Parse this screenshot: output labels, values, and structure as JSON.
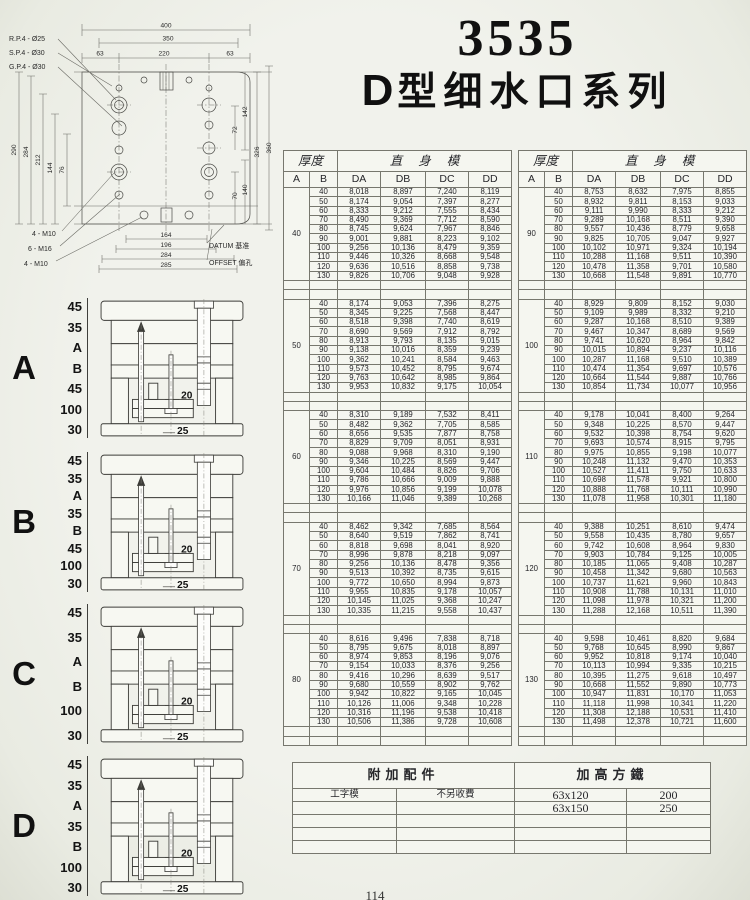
{
  "page": {
    "page_number": "114"
  },
  "colors": {
    "paper": "#f1f2ec",
    "ink": "#222222",
    "table_line": "#77776e"
  },
  "title": {
    "model": "3535",
    "series_prefix": "D",
    "series_text": "型细水口系列"
  },
  "drawing": {
    "callouts_top": [
      "R.P.4 - Ø25",
      "S.P.4 - Ø30",
      "G.P.4 - Ø30"
    ],
    "dims_top": [
      "400",
      "350",
      "63",
      "220",
      "63"
    ],
    "dims_left": [
      "290",
      "284",
      "212",
      "144",
      "76"
    ],
    "dims_right": [
      "142",
      "72",
      "326",
      "360",
      "70",
      "140"
    ],
    "dims_bottom": [
      "164",
      "196",
      "284",
      "285"
    ],
    "callouts_bottom": [
      "4 - M10",
      "6 - M16",
      "4 - M10"
    ],
    "datum_label": "DATUM 基准",
    "offset_label": "OFFSET 偏孔"
  },
  "diagrams": [
    {
      "label": "A",
      "stack": [
        "45",
        "35",
        "A",
        "B",
        "45",
        "100",
        "30"
      ],
      "inner": [
        "20",
        "25"
      ]
    },
    {
      "label": "B",
      "stack": [
        "45",
        "35",
        "A",
        "35",
        "B",
        "45",
        "100",
        "30"
      ],
      "inner": [
        "20",
        "25"
      ]
    },
    {
      "label": "C",
      "stack": [
        "45",
        "35",
        "A",
        "B",
        "100",
        "30"
      ],
      "inner": [
        "20",
        "25"
      ]
    },
    {
      "label": "D",
      "stack": [
        "45",
        "35",
        "A",
        "35",
        "B",
        "100",
        "30"
      ],
      "inner": [
        "20",
        "25"
      ]
    }
  ],
  "price_table": {
    "header_thickness": "厚度",
    "header_straight": "直身模",
    "col_a": "A",
    "col_b": "B",
    "value_cols": [
      "DA",
      "DB",
      "DC",
      "DD"
    ],
    "left_blocks": [
      {
        "a": "40",
        "rows": [
          [
            "40",
            "8,018",
            "8,897",
            "7,240",
            "8,119"
          ],
          [
            "50",
            "8,174",
            "9,054",
            "7,397",
            "8,277"
          ],
          [
            "60",
            "8,333",
            "9,212",
            "7,555",
            "8,434"
          ],
          [
            "70",
            "8,490",
            "9,369",
            "7,712",
            "8,590"
          ],
          [
            "80",
            "8,745",
            "9,624",
            "7,967",
            "8,846"
          ],
          [
            "90",
            "9,001",
            "9,881",
            "8,223",
            "9,102"
          ],
          [
            "100",
            "9,256",
            "10,136",
            "8,479",
            "9,359"
          ],
          [
            "110",
            "9,446",
            "10,326",
            "8,668",
            "9,548"
          ],
          [
            "120",
            "9,636",
            "10,516",
            "8,858",
            "9,738"
          ],
          [
            "130",
            "9,826",
            "10,706",
            "9,048",
            "9,928"
          ]
        ]
      },
      {
        "a": "50",
        "rows": [
          [
            "40",
            "8,174",
            "9,053",
            "7,396",
            "8,275"
          ],
          [
            "50",
            "8,345",
            "9,225",
            "7,568",
            "8,447"
          ],
          [
            "60",
            "8,518",
            "9,398",
            "7,740",
            "8,619"
          ],
          [
            "70",
            "8,690",
            "9,569",
            "7,912",
            "8,792"
          ],
          [
            "80",
            "8,913",
            "9,793",
            "8,135",
            "9,015"
          ],
          [
            "90",
            "9,138",
            "10,016",
            "8,359",
            "9,239"
          ],
          [
            "100",
            "9,362",
            "10,241",
            "8,584",
            "9,463"
          ],
          [
            "110",
            "9,573",
            "10,452",
            "8,795",
            "9,674"
          ],
          [
            "120",
            "9,763",
            "10,642",
            "8,985",
            "9,864"
          ],
          [
            "130",
            "9,953",
            "10,832",
            "9,175",
            "10,054"
          ]
        ]
      },
      {
        "a": "60",
        "rows": [
          [
            "40",
            "8,310",
            "9,189",
            "7,532",
            "8,411"
          ],
          [
            "50",
            "8,482",
            "9,362",
            "7,705",
            "8,585"
          ],
          [
            "60",
            "8,656",
            "9,535",
            "7,877",
            "8,758"
          ],
          [
            "70",
            "8,829",
            "9,709",
            "8,051",
            "8,931"
          ],
          [
            "80",
            "9,088",
            "9,968",
            "8,310",
            "9,190"
          ],
          [
            "90",
            "9,346",
            "10,225",
            "8,569",
            "9,447"
          ],
          [
            "100",
            "9,604",
            "10,484",
            "8,826",
            "9,706"
          ],
          [
            "110",
            "9,786",
            "10,666",
            "9,009",
            "9,888"
          ],
          [
            "120",
            "9,976",
            "10,856",
            "9,199",
            "10,078"
          ],
          [
            "130",
            "10,166",
            "11,046",
            "9,389",
            "10,268"
          ]
        ]
      },
      {
        "a": "70",
        "rows": [
          [
            "40",
            "8,462",
            "9,342",
            "7,685",
            "8,564"
          ],
          [
            "50",
            "8,640",
            "9,519",
            "7,862",
            "8,741"
          ],
          [
            "60",
            "8,818",
            "9,698",
            "8,041",
            "8,920"
          ],
          [
            "70",
            "8,996",
            "9,878",
            "8,218",
            "9,097"
          ],
          [
            "80",
            "9,256",
            "10,136",
            "8,478",
            "9,356"
          ],
          [
            "90",
            "9,513",
            "10,392",
            "8,735",
            "9,615"
          ],
          [
            "100",
            "9,772",
            "10,650",
            "8,994",
            "9,873"
          ],
          [
            "110",
            "9,955",
            "10,835",
            "9,178",
            "10,057"
          ],
          [
            "120",
            "10,145",
            "11,025",
            "9,368",
            "10,247"
          ],
          [
            "130",
            "10,335",
            "11,215",
            "9,558",
            "10,437"
          ]
        ]
      },
      {
        "a": "80",
        "rows": [
          [
            "40",
            "8,616",
            "9,496",
            "7,838",
            "8,718"
          ],
          [
            "50",
            "8,795",
            "9,675",
            "8,018",
            "8,897"
          ],
          [
            "60",
            "8,974",
            "9,853",
            "8,196",
            "9,076"
          ],
          [
            "70",
            "9,154",
            "10,033",
            "8,376",
            "9,256"
          ],
          [
            "80",
            "9,416",
            "10,296",
            "8,639",
            "9,517"
          ],
          [
            "90",
            "9,680",
            "10,559",
            "8,902",
            "9,762"
          ],
          [
            "100",
            "9,942",
            "10,822",
            "9,165",
            "10,045"
          ],
          [
            "110",
            "10,126",
            "11,006",
            "9,348",
            "10,228"
          ],
          [
            "120",
            "10,316",
            "11,196",
            "9,538",
            "10,418"
          ],
          [
            "130",
            "10,506",
            "11,386",
            "9,728",
            "10,608"
          ]
        ]
      }
    ],
    "right_blocks": [
      {
        "a": "90",
        "rows": [
          [
            "40",
            "8,753",
            "8,632",
            "7,975",
            "8,855"
          ],
          [
            "50",
            "8,932",
            "9,811",
            "8,153",
            "9,033"
          ],
          [
            "60",
            "9,111",
            "9,990",
            "8,333",
            "9,212"
          ],
          [
            "70",
            "9,289",
            "10,168",
            "8,511",
            "9,390"
          ],
          [
            "80",
            "9,557",
            "10,436",
            "8,779",
            "9,658"
          ],
          [
            "90",
            "9,825",
            "10,705",
            "9,047",
            "9,927"
          ],
          [
            "100",
            "10,102",
            "10,971",
            "9,324",
            "10,194"
          ],
          [
            "110",
            "10,288",
            "11,168",
            "9,511",
            "10,390"
          ],
          [
            "120",
            "10,478",
            "11,358",
            "9,701",
            "10,580"
          ],
          [
            "130",
            "10,668",
            "11,548",
            "9,891",
            "10,770"
          ]
        ]
      },
      {
        "a": "100",
        "rows": [
          [
            "40",
            "8,929",
            "9,809",
            "8,152",
            "9,030"
          ],
          [
            "50",
            "9,109",
            "9,989",
            "8,332",
            "9,210"
          ],
          [
            "60",
            "9,287",
            "10,168",
            "8,510",
            "9,389"
          ],
          [
            "70",
            "9,467",
            "10,347",
            "8,689",
            "9,569"
          ],
          [
            "80",
            "9,741",
            "10,620",
            "8,964",
            "9,842"
          ],
          [
            "90",
            "10,015",
            "10,894",
            "9,237",
            "10,116"
          ],
          [
            "100",
            "10,287",
            "11,168",
            "9,510",
            "10,389"
          ],
          [
            "110",
            "10,474",
            "11,354",
            "9,697",
            "10,576"
          ],
          [
            "120",
            "10,664",
            "11,544",
            "9,887",
            "10,766"
          ],
          [
            "130",
            "10,854",
            "11,734",
            "10,077",
            "10,956"
          ]
        ]
      },
      {
        "a": "110",
        "rows": [
          [
            "40",
            "9,178",
            "10,041",
            "8,400",
            "9,264"
          ],
          [
            "50",
            "9,348",
            "10,225",
            "8,570",
            "9,447"
          ],
          [
            "60",
            "9,532",
            "10,398",
            "8,754",
            "9,620"
          ],
          [
            "70",
            "9,693",
            "10,574",
            "8,915",
            "9,795"
          ],
          [
            "80",
            "9,975",
            "10,855",
            "9,198",
            "10,077"
          ],
          [
            "90",
            "10,248",
            "11,132",
            "9,470",
            "10,353"
          ],
          [
            "100",
            "10,527",
            "11,411",
            "9,750",
            "10,633"
          ],
          [
            "110",
            "10,698",
            "11,578",
            "9,921",
            "10,800"
          ],
          [
            "120",
            "10,888",
            "11,768",
            "10,111",
            "10,990"
          ],
          [
            "130",
            "11,078",
            "11,958",
            "10,301",
            "11,180"
          ]
        ]
      },
      {
        "a": "120",
        "rows": [
          [
            "40",
            "9,388",
            "10,251",
            "8,610",
            "9,474"
          ],
          [
            "50",
            "9,558",
            "10,435",
            "8,780",
            "9,657"
          ],
          [
            "60",
            "9,742",
            "10,608",
            "8,964",
            "9,830"
          ],
          [
            "70",
            "9,903",
            "10,784",
            "9,125",
            "10,005"
          ],
          [
            "80",
            "10,185",
            "11,065",
            "9,408",
            "10,287"
          ],
          [
            "90",
            "10,458",
            "11,342",
            "9,680",
            "10,563"
          ],
          [
            "100",
            "10,737",
            "11,621",
            "9,960",
            "10,843"
          ],
          [
            "110",
            "10,908",
            "11,788",
            "10,131",
            "11,010"
          ],
          [
            "120",
            "11,098",
            "11,978",
            "10,321",
            "11,200"
          ],
          [
            "130",
            "11,288",
            "12,168",
            "10,511",
            "11,390"
          ]
        ]
      },
      {
        "a": "130",
        "rows": [
          [
            "40",
            "9,598",
            "10,461",
            "8,820",
            "9,684"
          ],
          [
            "50",
            "9,768",
            "10,645",
            "8,990",
            "9,867"
          ],
          [
            "60",
            "9,952",
            "10,818",
            "9,174",
            "10,040"
          ],
          [
            "70",
            "10,113",
            "10,994",
            "9,335",
            "10,215"
          ],
          [
            "80",
            "10,395",
            "11,275",
            "9,618",
            "10,497"
          ],
          [
            "90",
            "10,668",
            "11,552",
            "9,890",
            "10,773"
          ],
          [
            "100",
            "10,947",
            "11,831",
            "10,170",
            "11,053"
          ],
          [
            "110",
            "11,118",
            "11,998",
            "10,341",
            "11,220"
          ],
          [
            "120",
            "11,308",
            "12,188",
            "10,531",
            "11,410"
          ],
          [
            "130",
            "11,498",
            "12,378",
            "10,721",
            "11,600"
          ]
        ]
      }
    ]
  },
  "accessories": {
    "header_left": "附加配件",
    "header_right": "加高方鐵",
    "rows": [
      [
        "工字模",
        "不另收費",
        "63x120",
        "200"
      ],
      [
        "",
        "",
        "63x150",
        "250"
      ],
      [
        "",
        "",
        "",
        ""
      ],
      [
        "",
        "",
        "",
        ""
      ],
      [
        "",
        "",
        "",
        ""
      ]
    ]
  }
}
